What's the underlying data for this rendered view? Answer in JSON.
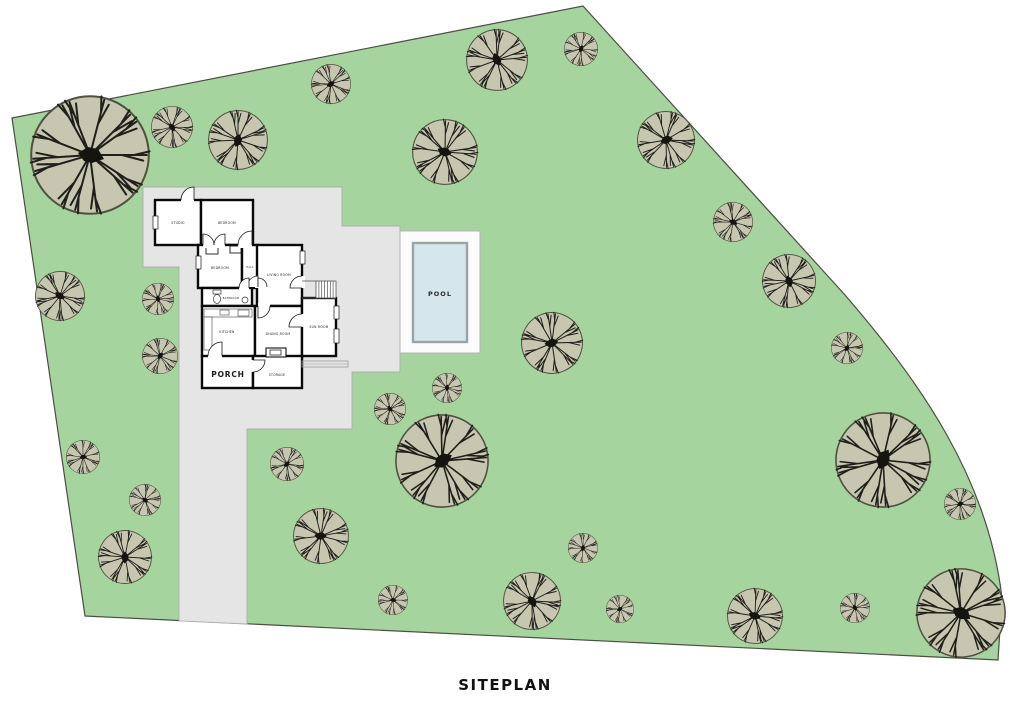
{
  "title": "SITEPLAN",
  "colors": {
    "page": "#ffffff",
    "grass": "#a5d49e",
    "lot_border": "#4d4d44",
    "pad": "#e5e5e5",
    "pad_border": "#aeaeae",
    "deck": "#fbfbfb",
    "deck_border": "#b5b5b5",
    "pool_water": "#d5e7ec",
    "pool_border": "#9aa4a6",
    "wall": "#0a0a0a",
    "room_fill": "#ffffff",
    "thin_line": "#1a1a1a",
    "canopy": "#c6c6b1",
    "canopy_edge": "#50503e",
    "branch": "#20201a",
    "label": "#1a1a1a"
  },
  "lot": {
    "path": "M 12,118 L 583,6 L 845,295 C 920,382 988,478 1002,598 L 998,660 L 85,616 Z"
  },
  "pad": {
    "path": "M 143,187 L 342,187 L 342,226 L 400,226 L 400,372 L 352,372 L 352,429 L 247,429 L 247,624 L 179,621 L 179,267 L 143,267 Z"
  },
  "pool": {
    "deck": [
      400,
      231,
      80,
      122
    ],
    "basin": [
      413,
      243,
      54,
      99
    ],
    "label": "POOL",
    "label_pos": [
      440,
      296
    ]
  },
  "trees": [
    [
      90,
      155,
      60
    ],
    [
      172,
      127,
      21
    ],
    [
      238,
      140,
      30
    ],
    [
      331,
      84,
      20
    ],
    [
      445,
      152,
      33
    ],
    [
      497,
      60,
      31
    ],
    [
      581,
      49,
      17
    ],
    [
      666,
      140,
      29
    ],
    [
      733,
      222,
      20
    ],
    [
      789,
      281,
      27
    ],
    [
      847,
      348,
      16
    ],
    [
      552,
      343,
      31
    ],
    [
      60,
      296,
      25
    ],
    [
      158,
      299,
      16
    ],
    [
      160,
      356,
      18
    ],
    [
      83,
      457,
      17
    ],
    [
      145,
      500,
      16
    ],
    [
      125,
      557,
      27
    ],
    [
      287,
      464,
      17
    ],
    [
      321,
      536,
      28
    ],
    [
      390,
      409,
      16
    ],
    [
      447,
      388,
      15
    ],
    [
      442,
      461,
      47
    ],
    [
      393,
      600,
      15
    ],
    [
      532,
      601,
      29
    ],
    [
      583,
      548,
      15
    ],
    [
      620,
      609,
      14
    ],
    [
      755,
      616,
      28
    ],
    [
      855,
      608,
      15
    ],
    [
      883,
      460,
      48
    ],
    [
      960,
      504,
      16
    ],
    [
      961,
      613,
      45
    ]
  ],
  "house": {
    "rooms": [
      {
        "label": "STUDIO",
        "rect": [
          155,
          200,
          46,
          45
        ],
        "lx": 178,
        "ly": 224,
        "fs": 3.1
      },
      {
        "label": "BEDROOM",
        "rect": [
          201,
          200,
          52,
          45
        ],
        "lx": 227,
        "ly": 224,
        "fs": 3.1
      },
      {
        "label": "BEDROOM",
        "rect": [
          198,
          245,
          44,
          43
        ],
        "lx": 220,
        "ly": 269,
        "fs": 3.1
      },
      {
        "label": "HALL",
        "rect": [
          242,
          245,
          16,
          43
        ],
        "lx": 250,
        "ly": 268,
        "fs": 2.5
      },
      {
        "label": "LIVING ROOM",
        "rect": [
          257,
          245,
          45,
          61
        ],
        "lx": 279,
        "ly": 276,
        "fs": 3.1
      },
      {
        "label": "BATHROOM",
        "rect": [
          202,
          288,
          50,
          18
        ],
        "lx": 231,
        "ly": 299,
        "fs": 2.5
      },
      {
        "label": "KITCHEN",
        "rect": [
          202,
          306,
          53,
          51
        ],
        "lx": 227,
        "ly": 333,
        "fs": 3.1
      },
      {
        "label": "DINING ROOM",
        "rect": [
          255,
          306,
          47,
          51
        ],
        "lx": 278,
        "ly": 335,
        "fs": 3.1
      },
      {
        "label": "SUN ROOM",
        "rect": [
          302,
          298,
          34,
          58
        ],
        "lx": 319,
        "ly": 328,
        "fs": 3.1
      },
      {
        "label": "PORCH",
        "rect": [
          202,
          356,
          51,
          32
        ],
        "lx": 228,
        "ly": 377,
        "fs": 7.5,
        "bold": true
      },
      {
        "label": "STORAGE",
        "rect": [
          253,
          356,
          49,
          32
        ],
        "lx": 277,
        "ly": 376,
        "fs": 3.1
      }
    ],
    "closets": [
      [
        206,
        246,
        12,
        8
      ],
      [
        230,
        246,
        11,
        7
      ]
    ],
    "windows": [
      [
        153,
        216,
        5,
        13
      ],
      [
        196,
        256,
        5,
        13
      ],
      [
        300,
        251,
        5,
        13
      ],
      [
        334,
        306,
        5,
        13
      ],
      [
        334,
        329,
        5,
        14
      ]
    ],
    "doors": [
      {
        "hinge": [
          194,
          200
        ],
        "r": 13,
        "closed": 180,
        "open": 270,
        "gap": [
          181,
          196,
          13,
          7
        ]
      },
      {
        "hinge": [
          203,
          245
        ],
        "r": 11,
        "closed": 0,
        "open": 270,
        "gap": [
          203,
          241,
          22,
          7
        ]
      },
      {
        "hinge": [
          225,
          245
        ],
        "r": 11,
        "closed": 180,
        "open": 270,
        "gap": null
      },
      {
        "hinge": [
          252,
          245
        ],
        "r": 14,
        "closed": 180,
        "open": 270,
        "gap": [
          238,
          241,
          14,
          7
        ]
      },
      {
        "hinge": [
          258,
          287
        ],
        "r": 11,
        "closed": 180,
        "open": 270,
        "gap": [
          255,
          276,
          5,
          12
        ]
      },
      {
        "hinge": [
          258,
          287
        ],
        "r": 9,
        "closed": 0,
        "open": 270,
        "gap": null
      },
      {
        "hinge": [
          249,
          288
        ],
        "r": 10,
        "closed": 180,
        "open": 270,
        "gap": [
          239,
          285,
          10,
          6
        ]
      },
      {
        "hinge": [
          258,
          306
        ],
        "r": 12,
        "closed": 0,
        "open": 90,
        "gap": [
          258,
          303,
          12,
          6
        ]
      },
      {
        "hinge": [
          302,
          288
        ],
        "r": 12,
        "closed": 270,
        "open": 180,
        "gap": [
          299,
          276,
          6,
          12
        ]
      },
      {
        "hinge": [
          302,
          327
        ],
        "r": 13,
        "closed": 270,
        "open": 180,
        "gap": [
          299,
          314,
          6,
          13
        ]
      },
      {
        "hinge": [
          222,
          356
        ],
        "r": 14,
        "closed": 180,
        "open": 270,
        "gap": [
          208,
          353,
          14,
          6
        ]
      },
      {
        "hinge": [
          253,
          360
        ],
        "r": 12,
        "closed": 90,
        "open": 0,
        "gap": [
          250,
          360,
          6,
          12
        ]
      }
    ],
    "fireplace": {
      "outer": [
        266,
        348,
        20,
        9
      ],
      "inner": [
        270,
        350,
        11,
        5
      ]
    },
    "bath": {
      "toilet_bowl": [
        217,
        299,
        3.5,
        4.5
      ],
      "toilet_tank": [
        213,
        290,
        8,
        4
      ],
      "sink": [
        245,
        300,
        3
      ]
    },
    "kitchen": {
      "counters": [
        [
          204,
          309,
          48,
          8
        ],
        [
          204,
          317,
          8,
          33
        ]
      ],
      "sink": [
        220,
        310,
        9,
        5
      ],
      "stove": [
        238,
        310,
        11,
        6
      ]
    },
    "stairs": {
      "hatch_rect": [
        316,
        281,
        20,
        17
      ],
      "lines": [
        [
          302,
          281,
          316,
          281
        ],
        [
          302,
          298,
          336,
          298
        ]
      ],
      "steps": 6
    },
    "stoop": {
      "rect": [
        302,
        361,
        46,
        6
      ]
    }
  }
}
